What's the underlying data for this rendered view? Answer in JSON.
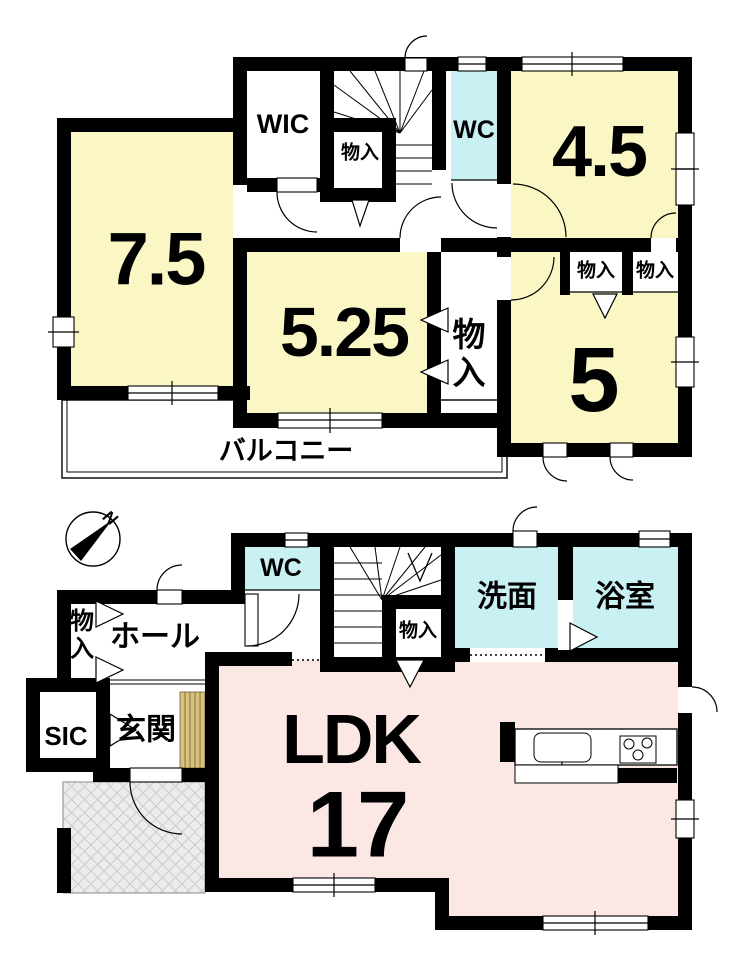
{
  "floor2": {
    "room_75": "7.5",
    "wic": "WIC",
    "closet_a": "物入",
    "wc": "WC",
    "room_45": "4.5",
    "room_525": "5.25",
    "closet_vertical": "物入",
    "closet_c": "物入",
    "closet_d": "物入",
    "room_5": "5",
    "balcony": "バルコニー"
  },
  "floor1": {
    "wc": "WC",
    "hall": "ホール",
    "closet_hall": "物入",
    "closet_stairs": "物入",
    "washroom": "洗面",
    "bathroom": "浴室",
    "sic": "SIC",
    "entrance": "玄関",
    "ldk": "LDK",
    "ldk_size": "17"
  },
  "compass": {
    "north": "N"
  },
  "colors": {
    "room_yellow": "#faf7c5",
    "wet_cyan": "#c9f1f3",
    "ldk_pink": "#fbe7e4",
    "step_tan": "#d9c27c"
  }
}
